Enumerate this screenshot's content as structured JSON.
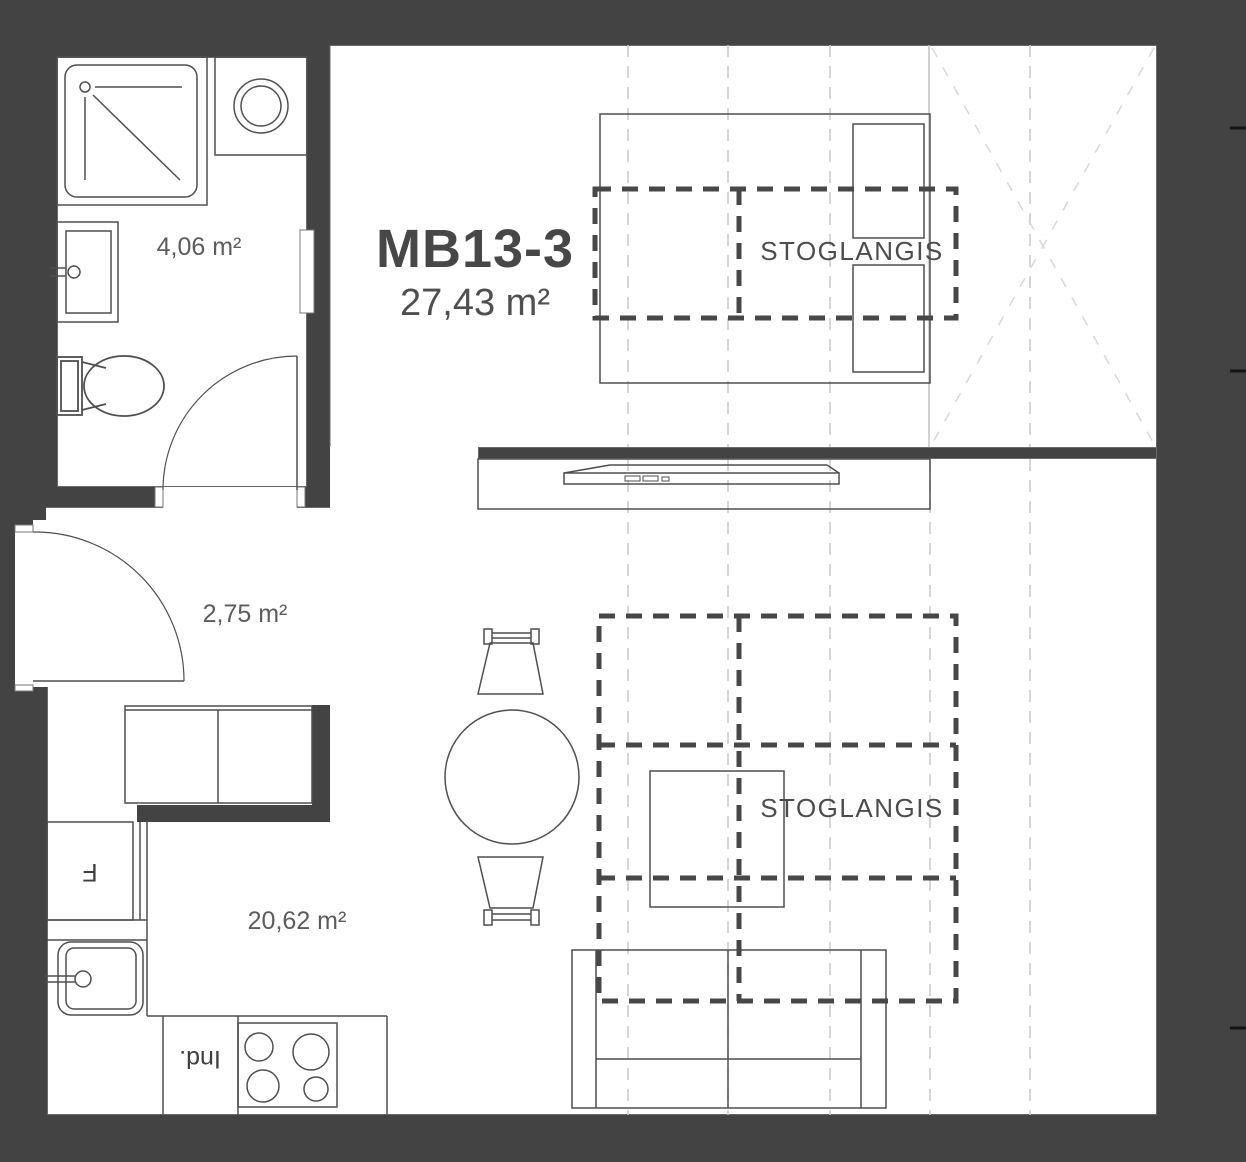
{
  "plan": {
    "title": "MB13-3",
    "total_area": "27,43 m²"
  },
  "rooms": {
    "bathroom": {
      "area": "4,06 m²"
    },
    "hall": {
      "area": "2,75 m²"
    },
    "living_kitchen": {
      "area": "20,62 m²"
    }
  },
  "skylights": {
    "bedroom_label": "STOGLANGIS",
    "living_label": "STOGLANGIS"
  },
  "appliances": {
    "fridge_label": "F",
    "dishwasher_label": "Ind."
  },
  "furniture_icons": [
    "shower",
    "washing-machine",
    "washbasin",
    "toilet",
    "door-swing",
    "hall-cabinet",
    "fridge",
    "kitchen-sink",
    "cooktop",
    "dishwasher",
    "bed",
    "pillows",
    "wardrobe-cross",
    "tv-unit",
    "dining-chair",
    "dining-table",
    "coffee-table",
    "sofa",
    "skylight-dashed-outline"
  ],
  "colors": {
    "background": "#434343",
    "floor": "#ffffff",
    "wall_line": "#6a6a6a",
    "furniture_line": "#4f4f4f",
    "skylight_dash": "#474747",
    "grid_dash": "#c9c9c9",
    "closet_cross": "#d8d8d8",
    "text": "#555555",
    "tick": "#141414"
  }
}
